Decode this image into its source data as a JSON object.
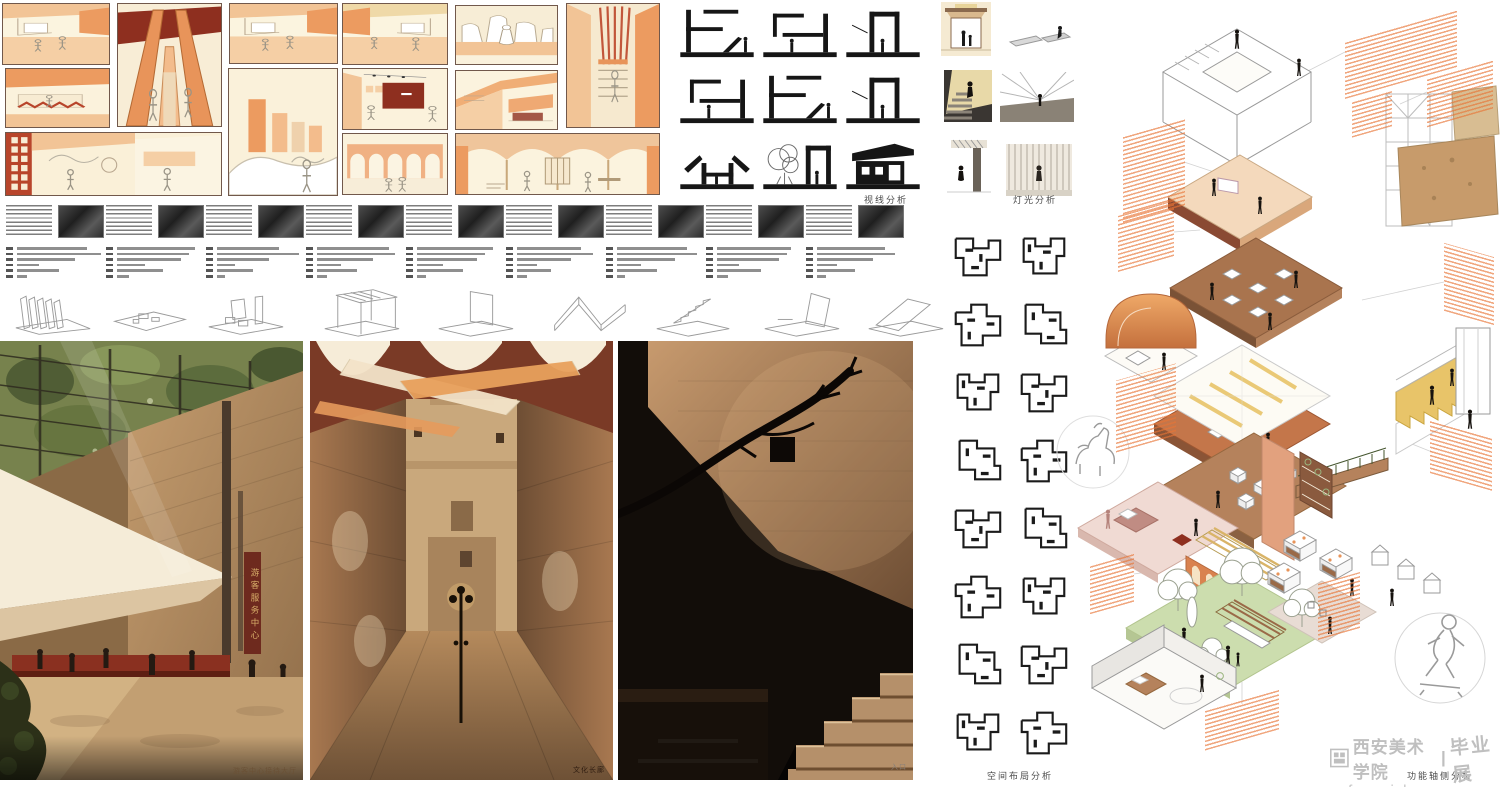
{
  "page": {
    "width": 1500,
    "height": 787,
    "background": "#ffffff"
  },
  "palette": {
    "cream": "#FAF2DB",
    "peach": "#F3C193",
    "orange": "#E8945A",
    "deep_orange": "#EC9B60",
    "dark_red": "#8E2F1F",
    "maroon": "#7A3A26",
    "box_border": "#71584b",
    "ink": "#1b1b1b",
    "bar_gray": "#8F8F8F",
    "annotation_orange": "#E87435",
    "lawn_green": "#CCDDAE",
    "pink": "#F0DAD3",
    "salmon": "#E2A17E",
    "brown": "#9A6A48",
    "stair_yellow": "#E8C469",
    "tan_wall": "#C49A6F",
    "sign_red": "#6E2A1E",
    "sign_gold": "#D9B06A"
  },
  "labels": {
    "sight": "视线分析",
    "light": "灯光分析",
    "plans": "空间布局分析",
    "axon": "功能轴侧分析"
  },
  "renders": {
    "r1_caption": "游客中心接待大厅",
    "r2_caption": "文化长廊",
    "r3_caption": "入口",
    "sign_vertical": "游客服务中心"
  },
  "watermark": {
    "school": "西安美术学院",
    "divider": "|",
    "exhibition": "毕业展",
    "url": "xafa.meishu.org.cn"
  },
  "collage": {
    "boxes": [
      {
        "x": 2,
        "y": 3,
        "w": 108,
        "h": 62,
        "v": "interiorA"
      },
      {
        "x": 5,
        "y": 68,
        "w": 105,
        "h": 60,
        "v": "reception"
      },
      {
        "x": 117,
        "y": 3,
        "w": 105,
        "h": 124,
        "v": "aframe"
      },
      {
        "x": 229,
        "y": 3,
        "w": 109,
        "h": 61,
        "v": "interiorA"
      },
      {
        "x": 228,
        "y": 68,
        "w": 110,
        "h": 128,
        "v": "cityblocks"
      },
      {
        "x": 5,
        "y": 132,
        "w": 217,
        "h": 64,
        "v": "lounge"
      },
      {
        "x": 342,
        "y": 3,
        "w": 106,
        "h": 62,
        "v": "interiorB"
      },
      {
        "x": 455,
        "y": 5,
        "w": 103,
        "h": 60,
        "v": "rock"
      },
      {
        "x": 566,
        "y": 3,
        "w": 94,
        "h": 125,
        "v": "stairslats"
      },
      {
        "x": 342,
        "y": 68,
        "w": 106,
        "h": 62,
        "v": "gallery"
      },
      {
        "x": 455,
        "y": 70,
        "w": 103,
        "h": 60,
        "v": "beam"
      },
      {
        "x": 342,
        "y": 133,
        "w": 106,
        "h": 62,
        "v": "aqueduct"
      },
      {
        "x": 455,
        "y": 133,
        "w": 205,
        "h": 62,
        "v": "vaulted"
      }
    ]
  },
  "story_row": {
    "y": 205,
    "pitch": 100,
    "x0": 6,
    "units": [
      {
        "bars": [
          70,
          84,
          58,
          22,
          42,
          10
        ]
      },
      {
        "bars": [
          78,
          72,
          64,
          28,
          46,
          12
        ]
      },
      {
        "bars": [
          62,
          82,
          52,
          18,
          36,
          8
        ]
      },
      {
        "bars": [
          72,
          78,
          56,
          24,
          40,
          10
        ]
      },
      {
        "bars": [
          76,
          68,
          60,
          26,
          46,
          9
        ]
      },
      {
        "bars": [
          64,
          76,
          54,
          20,
          34,
          10
        ]
      },
      {
        "bars": [
          70,
          80,
          58,
          24,
          40,
          8
        ]
      },
      {
        "bars": [
          74,
          70,
          62,
          22,
          44,
          11
        ]
      },
      {
        "bars": [
          68,
          78,
          56,
          20,
          38,
          9
        ]
      }
    ]
  },
  "axon_row": {
    "y": 286,
    "h": 52,
    "sketches": [
      {
        "x": 8,
        "v": "fins"
      },
      {
        "x": 104,
        "v": "slab"
      },
      {
        "x": 200,
        "v": "bench3"
      },
      {
        "x": 316,
        "v": "canopy"
      },
      {
        "x": 430,
        "v": "panel"
      },
      {
        "x": 544,
        "v": "folded"
      },
      {
        "x": 648,
        "v": "stairwedge"
      },
      {
        "x": 756,
        "v": "tiltwall"
      },
      {
        "x": 860,
        "v": "ramp"
      }
    ]
  },
  "sight_section": {
    "x0": 678,
    "y0": 4,
    "colw": 83,
    "roww": 66,
    "w": 78,
    "h": 56,
    "glyphs": [
      {
        "col": 0,
        "row": 0,
        "v": "s1"
      },
      {
        "col": 1,
        "row": 0,
        "v": "s2"
      },
      {
        "col": 2,
        "row": 0,
        "v": "s3"
      },
      {
        "col": 0,
        "row": 1,
        "v": "s2"
      },
      {
        "col": 1,
        "row": 1,
        "v": "s1"
      },
      {
        "col": 2,
        "row": 1,
        "v": "s3"
      },
      {
        "col": 0,
        "row": 2,
        "v": "splay"
      },
      {
        "col": 1,
        "row": 2,
        "v": "tree"
      },
      {
        "col": 2,
        "row": 2,
        "v": "house"
      }
    ]
  },
  "plans_section": {
    "x0": 948,
    "y0": 228,
    "colw": 66,
    "pitch": 68,
    "w": 58,
    "h": 56,
    "items": [
      {
        "col": 0,
        "row": 0,
        "v": "p1"
      },
      {
        "col": 1,
        "row": 0,
        "v": "p2"
      },
      {
        "col": 0,
        "row": 1,
        "v": "p3"
      },
      {
        "col": 1,
        "row": 1,
        "v": "p4"
      },
      {
        "col": 0,
        "row": 2,
        "v": "p2"
      },
      {
        "col": 1,
        "row": 2,
        "v": "p1"
      },
      {
        "col": 0,
        "row": 3,
        "v": "p4"
      },
      {
        "col": 1,
        "row": 3,
        "v": "p3"
      },
      {
        "col": 0,
        "row": 4,
        "v": "p1"
      },
      {
        "col": 1,
        "row": 4,
        "v": "p4"
      },
      {
        "col": 0,
        "row": 5,
        "v": "p3"
      },
      {
        "col": 1,
        "row": 5,
        "v": "p2"
      },
      {
        "col": 0,
        "row": 6,
        "v": "p4"
      },
      {
        "col": 1,
        "row": 6,
        "v": "p1"
      },
      {
        "col": 0,
        "row": 7,
        "v": "p2"
      },
      {
        "col": 1,
        "row": 7,
        "v": "p3"
      }
    ]
  },
  "axon_section": {
    "annotations": [
      [
        1345,
        25,
        112,
        58,
        -16
      ],
      [
        1427,
        68,
        66,
        50,
        -16
      ],
      [
        1123,
        128,
        62,
        86,
        -16
      ],
      [
        1118,
        208,
        56,
        56,
        -16
      ],
      [
        1444,
        250,
        50,
        68,
        16
      ],
      [
        1116,
        372,
        60,
        72,
        -16
      ],
      [
        1430,
        428,
        62,
        54,
        16
      ],
      [
        1090,
        560,
        44,
        48,
        -16
      ],
      [
        1318,
        578,
        42,
        56,
        -16
      ],
      [
        1205,
        700,
        74,
        40,
        -16
      ],
      [
        1352,
        96,
        40,
        36,
        -16
      ]
    ]
  }
}
